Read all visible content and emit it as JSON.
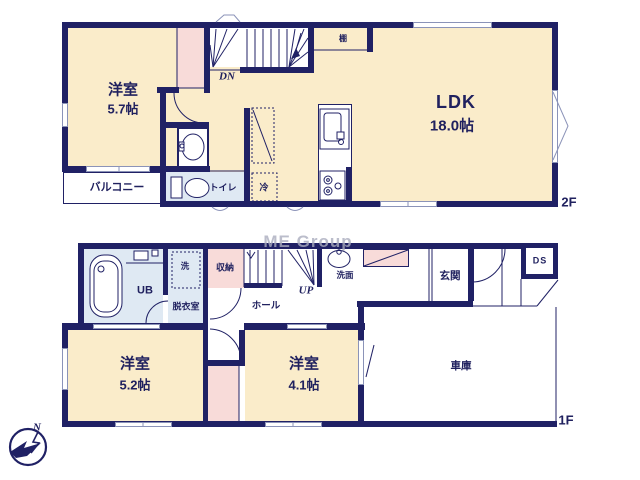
{
  "watermark": "ME Group",
  "compass": {
    "north": "N"
  },
  "floor2": {
    "floor_label": "2F",
    "western_room": {
      "name": "洋室",
      "size": "5.7帖"
    },
    "ldk": {
      "name": "LDK",
      "size": "18.0帖"
    },
    "balcony": "バルコニー",
    "toilet": "トイレ",
    "shelf": "棚",
    "fridge": "冷",
    "stairs_down": "DN"
  },
  "floor1": {
    "floor_label": "1F",
    "unit_bath": "UB",
    "dressing_room": "脱衣室",
    "washer": "洗",
    "storage": "収納",
    "hall": "ホール",
    "stairs_up": "UP",
    "washbasin": "洗面",
    "entrance": "玄関",
    "duct_space": "DS",
    "western_room_a": {
      "name": "洋室",
      "size": "5.2帖"
    },
    "western_room_b": {
      "name": "洋室",
      "size": "4.1帖"
    },
    "garage": "車庫"
  },
  "colors": {
    "wall": "#202165",
    "room_fill": "#faecca",
    "closet_fill": "#f8dbd9",
    "bath_fill": "#dfe9f3",
    "window_line": "#8b93b8",
    "watermark": "#aaadbe"
  }
}
